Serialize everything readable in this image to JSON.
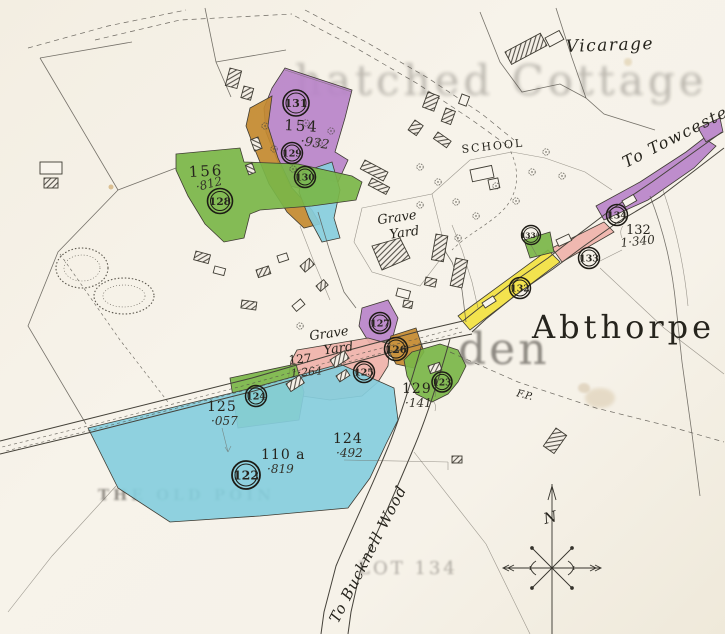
{
  "map_title": "Abthorpe",
  "labels": {
    "vicarage": "Vicarage",
    "school": "SCHOOL",
    "grave_yard_upper": {
      "line1": "Grave",
      "line2": "Yard"
    },
    "grave_yard_lower": {
      "line1": "Grave",
      "line2": "Yard"
    },
    "to_towcester": "To Towcester",
    "to_bucknell_wood": "To Bucknell Wood",
    "footpath_abbr": "F.P.",
    "compass_north": "N"
  },
  "lot_circles": {
    "c122": "122",
    "c123": "123",
    "c124": "124",
    "c125": "125",
    "c126": "126",
    "c127": "127",
    "c128": "128",
    "c129": "129",
    "c130": "130",
    "c131": "131",
    "c132": "132",
    "c133": "133",
    "c133a_base": "133",
    "c133a_sup": "A",
    "c134": "134"
  },
  "parcel_annotations": {
    "p154": {
      "number": "154",
      "acreage": "·932"
    },
    "p156": {
      "number": "156",
      "acreage": "·812"
    },
    "p132": {
      "number": "132",
      "acreage": "1·340"
    },
    "p127": {
      "number": "127",
      "acreage": "1·264"
    },
    "p125": {
      "number": "125",
      "acreage": "·057"
    },
    "p129": {
      "number": "129",
      "acreage": "·141"
    },
    "p124": {
      "number": "124",
      "acreage": "·492"
    },
    "p110a": {
      "number": "110 a",
      "acreage": "·819"
    }
  },
  "legend_colors": {
    "purple": "#b884c9",
    "orange": "#c38a2f",
    "green": "#7ab648",
    "blue": "#85cedd",
    "pink": "#efb3aa",
    "yellow": "#f2e240",
    "ink": "#3f3c33",
    "paper": "#f4efe6"
  },
  "bleed_through_text": {
    "top": "hatched Cottage",
    "middle": "den",
    "bottom_left": "THE OLD POIN",
    "bottom_center": "LOT 134"
  }
}
